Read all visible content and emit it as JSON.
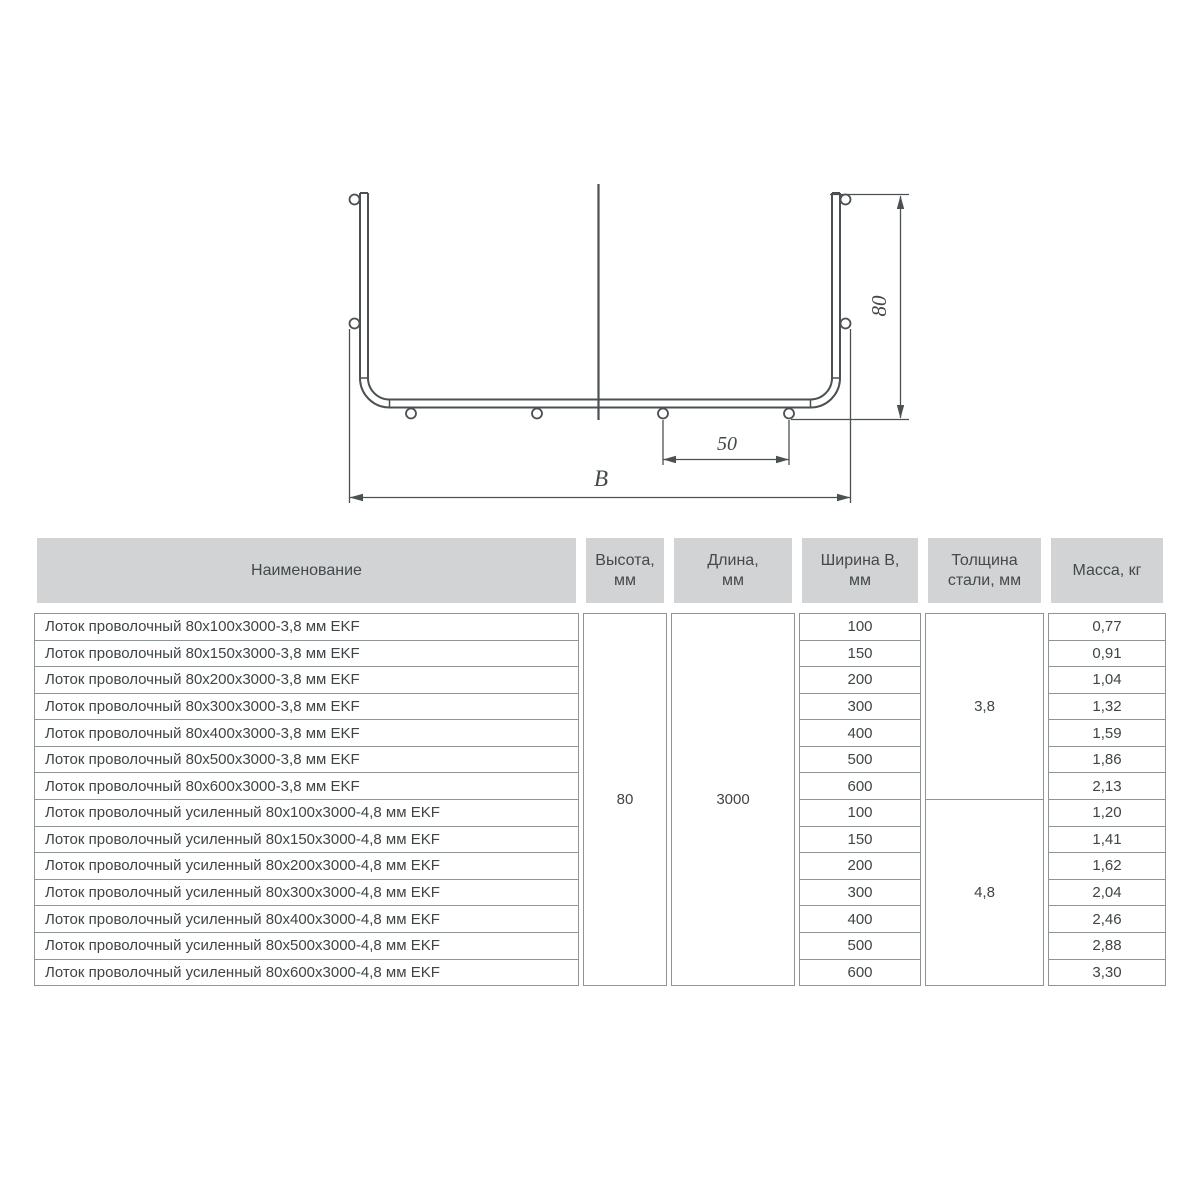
{
  "drawing": {
    "labels": {
      "height": "80",
      "hole_spacing": "50",
      "width": "В"
    }
  },
  "table": {
    "headers": {
      "name": "Наименование",
      "height": "Высота,\nмм",
      "length": "Длина,\nмм",
      "width": "Ширина В,\nмм",
      "thickness": "Толщина\nстали, мм",
      "mass": "Масса, кг"
    },
    "height_mm": "80",
    "length_mm": "3000",
    "thickness_groups": [
      "3,8",
      "4,8"
    ],
    "rows": [
      {
        "name": "Лоток проволочный 80x100x3000-3,8 мм EKF",
        "width_mm": "100",
        "mass_kg": "0,77"
      },
      {
        "name": "Лоток проволочный 80x150x3000-3,8 мм EKF",
        "width_mm": "150",
        "mass_kg": "0,91"
      },
      {
        "name": "Лоток проволочный 80x200x3000-3,8 мм EKF",
        "width_mm": "200",
        "mass_kg": "1,04"
      },
      {
        "name": "Лоток проволочный 80x300x3000-3,8 мм EKF",
        "width_mm": "300",
        "mass_kg": "1,32"
      },
      {
        "name": "Лоток проволочный 80x400x3000-3,8 мм EKF",
        "width_mm": "400",
        "mass_kg": "1,59"
      },
      {
        "name": "Лоток проволочный 80x500x3000-3,8 мм EKF",
        "width_mm": "500",
        "mass_kg": "1,86"
      },
      {
        "name": "Лоток проволочный 80x600x3000-3,8 мм EKF",
        "width_mm": "600",
        "mass_kg": "2,13"
      },
      {
        "name": "Лоток проволочный усиленный 80x100x3000-4,8 мм EKF",
        "width_mm": "100",
        "mass_kg": "1,20"
      },
      {
        "name": "Лоток проволочный усиленный 80x150x3000-4,8 мм EKF",
        "width_mm": "150",
        "mass_kg": "1,41"
      },
      {
        "name": "Лоток проволочный усиленный 80x200x3000-4,8 мм EKF",
        "width_mm": "200",
        "mass_kg": "1,62"
      },
      {
        "name": "Лоток проволочный усиленный 80x300x3000-4,8 мм EKF",
        "width_mm": "300",
        "mass_kg": "2,04"
      },
      {
        "name": "Лоток проволочный усиленный 80x400x3000-4,8 мм EKF",
        "width_mm": "400",
        "mass_kg": "2,46"
      },
      {
        "name": "Лоток проволочный усиленный 80x500x3000-4,8 мм EKF",
        "width_mm": "500",
        "mass_kg": "2,88"
      },
      {
        "name": "Лоток проволочный усиленный 80x600x3000-4,8 мм EKF",
        "width_mm": "600",
        "mass_kg": "3,30"
      }
    ]
  },
  "colors": {
    "header_bg": "#d1d3d4",
    "table_border": "#8f9496",
    "body_text": "#3f4446",
    "drawing_line": "#4b5052"
  }
}
